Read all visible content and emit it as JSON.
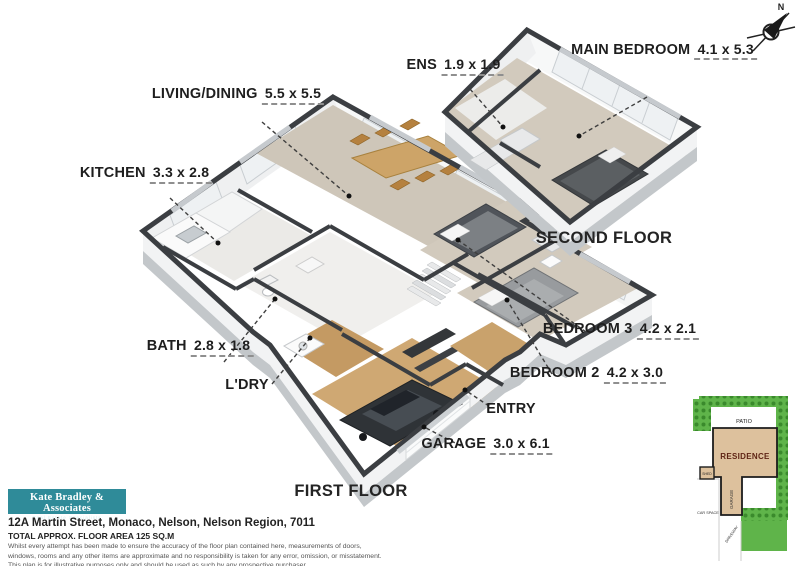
{
  "compass": {
    "label": "N"
  },
  "floor_titles": {
    "first": "FIRST FLOOR",
    "second": "SECOND FLOOR"
  },
  "rooms": {
    "living": {
      "name": "LIVING/DINING",
      "dims": "5.5 x 5.5"
    },
    "kitchen": {
      "name": "KITCHEN",
      "dims": "3.3 x 2.8"
    },
    "bath": {
      "name": "BATH",
      "dims": "2.8 x 1.8"
    },
    "laundry": {
      "name": "L'DRY"
    },
    "entry": {
      "name": "ENTRY"
    },
    "garage": {
      "name": "GARAGE",
      "dims": "3.0 x 6.1"
    },
    "bedroom2": {
      "name": "BEDROOM 2",
      "dims": "4.2 x 3.0"
    },
    "bedroom3": {
      "name": "BEDROOM 3",
      "dims": "4.2 x 2.1"
    },
    "ens": {
      "name": "ENS",
      "dims": "1.9 x 1.9"
    },
    "main_bedroom": {
      "line1": "MAIN",
      "line2": "BEDROOM",
      "dims": "4.1 x 5.3"
    }
  },
  "site_plan": {
    "patio": "PATIO",
    "residence": "RESIDENCE",
    "garage": "GARAGE",
    "shed": "SHED",
    "car_space": "CAR SPACE",
    "driveway": "DRIVEWAY"
  },
  "branding": {
    "agency": "Kate Bradley & Associates",
    "tagline": "Real Estate Specialists"
  },
  "footer": {
    "address": "12A Martin Street, Monaco, Nelson, Nelson Region, 7011",
    "area": "TOTAL APPROX. FLOOR AREA 125 SQ.M",
    "disclaimer_lines": [
      "Whilst every attempt has been made to ensure the accuracy of the floor plan contained here, measurements of doors,",
      "windows, rooms and any other items are approximate and no responsibility is taken for any error, omission, or misstatement.",
      "This plan is for illustrative purposes only and should be used as such by any prospective purchaser."
    ]
  },
  "colors": {
    "accent_teal": "#2f8b99",
    "grass": "#5fb44a",
    "residence_fill": "#ddc19d",
    "residence_text": "#5f2515",
    "wall": "#3b3e42"
  }
}
